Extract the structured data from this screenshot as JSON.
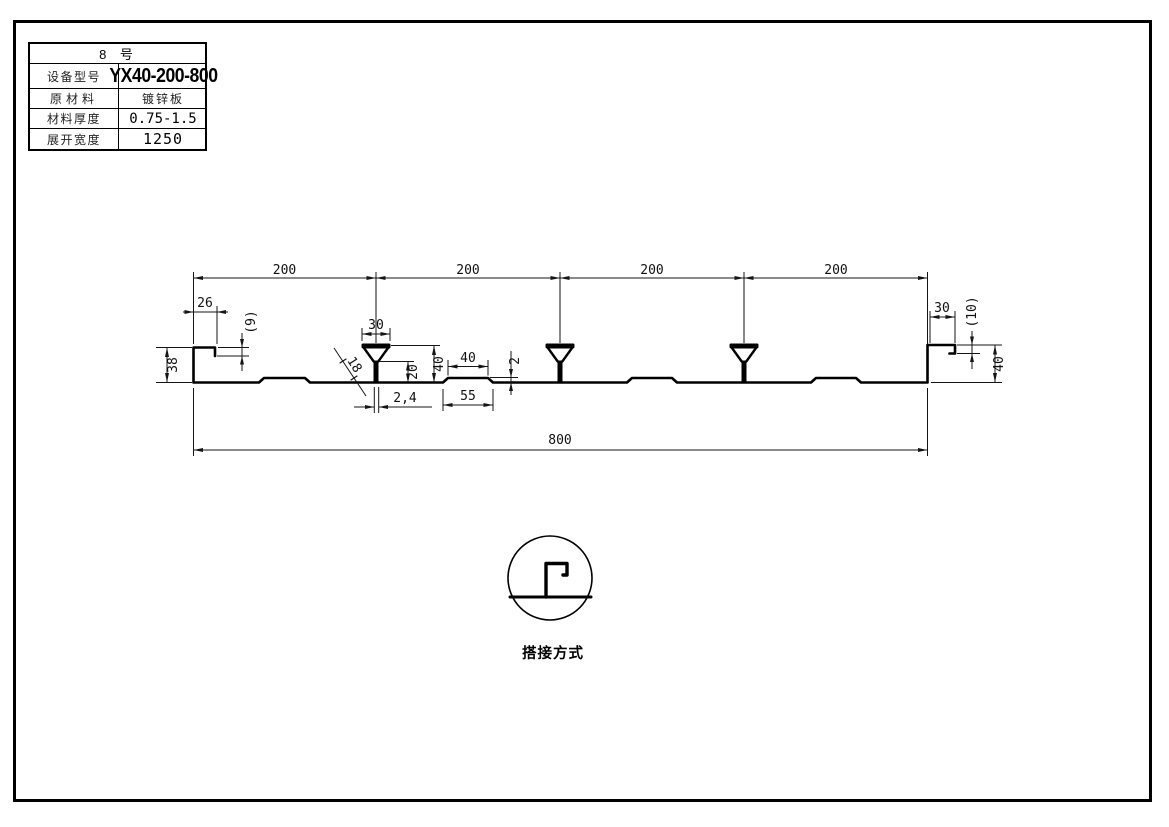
{
  "spec_table": {
    "title": "8 号",
    "rows": [
      {
        "label": "设备型号",
        "value": "YX40-200-800"
      },
      {
        "label": "原材料",
        "value": "镀锌板"
      },
      {
        "label": "材料厚度",
        "value": "0.75-1.5"
      },
      {
        "label": "展开宽度",
        "value": "1250"
      }
    ]
  },
  "drawing": {
    "dims": {
      "pitch": [
        "200",
        "200",
        "200",
        "200"
      ],
      "total_width": "800",
      "left_lip_width": "26",
      "left_lip_step": "(9)",
      "left_edge_height": "38",
      "rib_top_width": "30",
      "rib_slant": "18",
      "rib_stem_height": "20",
      "rib_height": "40",
      "rib_stem_width": "2,4",
      "stiffener_top_width": "40",
      "stiffener_base_width": "55",
      "stiffener_height": "2",
      "right_lip_width": "30",
      "right_lip_step": "(10)",
      "right_edge_height": "40"
    }
  },
  "detail": {
    "caption": "搭接方式"
  }
}
